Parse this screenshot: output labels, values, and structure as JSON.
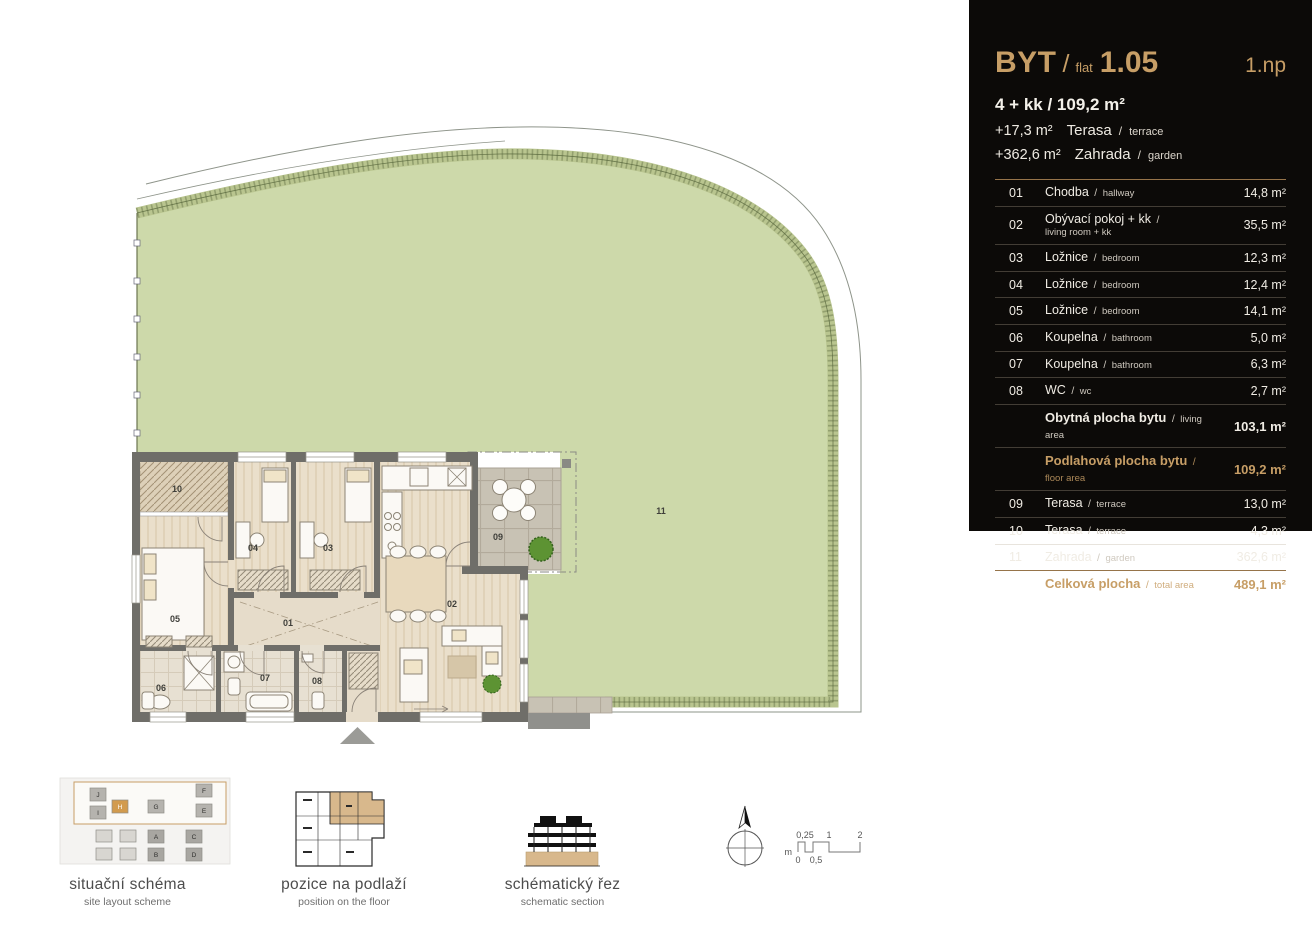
{
  "panel": {
    "title": "BYT",
    "title_sep": "/",
    "title_label": "flat",
    "unit_number": "1.05",
    "floor": "1.np",
    "disposition": "4 + kk / 109,2 m²",
    "terrace_line": {
      "value": "+17,3 m²",
      "cz": "Terasa",
      "sep": "/",
      "en": "terrace"
    },
    "garden_line": {
      "value": "+362,6 m²",
      "cz": "Zahrada",
      "sep": "/",
      "en": "garden"
    },
    "sep": "/",
    "rows": [
      {
        "num": "01",
        "cz": "Chodba",
        "en": "hallway",
        "area": "14,8 m²"
      },
      {
        "num": "02",
        "cz": "Obývací pokoj + kk",
        "en": "living room + kk",
        "area": "35,5 m²"
      },
      {
        "num": "03",
        "cz": "Ložnice",
        "en": "bedroom",
        "area": "12,3 m²"
      },
      {
        "num": "04",
        "cz": "Ložnice",
        "en": "bedroom",
        "area": "12,4 m²"
      },
      {
        "num": "05",
        "cz": "Ložnice",
        "en": "bedroom",
        "area": "14,1 m²"
      },
      {
        "num": "06",
        "cz": "Koupelna",
        "en": "bathroom",
        "area": "5,0 m²"
      },
      {
        "num": "07",
        "cz": "Koupelna",
        "en": "bathroom",
        "area": "6,3 m²"
      },
      {
        "num": "08",
        "cz": "WC",
        "en": "wc",
        "area": "2,7 m²"
      },
      {
        "num": "",
        "cz": "Obytná plocha bytu",
        "en": "living area",
        "area": "103,1 m²"
      },
      {
        "num": "",
        "cz": "Podlahová plocha bytu",
        "en": "floor area",
        "area": "109,2 m²"
      },
      {
        "num": "09",
        "cz": "Terasa",
        "en": "terrace",
        "area": "13,0 m²"
      },
      {
        "num": "10",
        "cz": "Terasa",
        "en": "terrace",
        "area": "4,3 m²"
      },
      {
        "num": "11",
        "cz": "Zahrada",
        "en": "garden",
        "area": "362,6 m²"
      },
      {
        "num": "",
        "cz": "Celková plocha",
        "en": "total area",
        "area": "489,1 m²"
      }
    ]
  },
  "plan": {
    "labels": [
      "01",
      "02",
      "03",
      "04",
      "05",
      "06",
      "07",
      "08",
      "09",
      "10",
      "11"
    ]
  },
  "thumbnails": [
    {
      "title": "situační schéma",
      "subtitle": "site layout scheme"
    },
    {
      "title": "pozice na podlaží",
      "subtitle": "position on the floor"
    },
    {
      "title": "schématický řez",
      "subtitle": "schematic section"
    }
  ],
  "site_blocks": [
    "J",
    "I",
    "H",
    "F",
    "E",
    "G",
    "A",
    "C",
    "B",
    "D"
  ],
  "scale_bar": {
    "unit": "m",
    "labels_top": [
      "0,25",
      "1",
      "2"
    ],
    "labels_bottom": [
      "0",
      "0,5"
    ]
  },
  "colors": {
    "accent_gold": "#c79e66",
    "panel_bg": "#0c0a08",
    "garden_green": "#cdd9aa"
  }
}
